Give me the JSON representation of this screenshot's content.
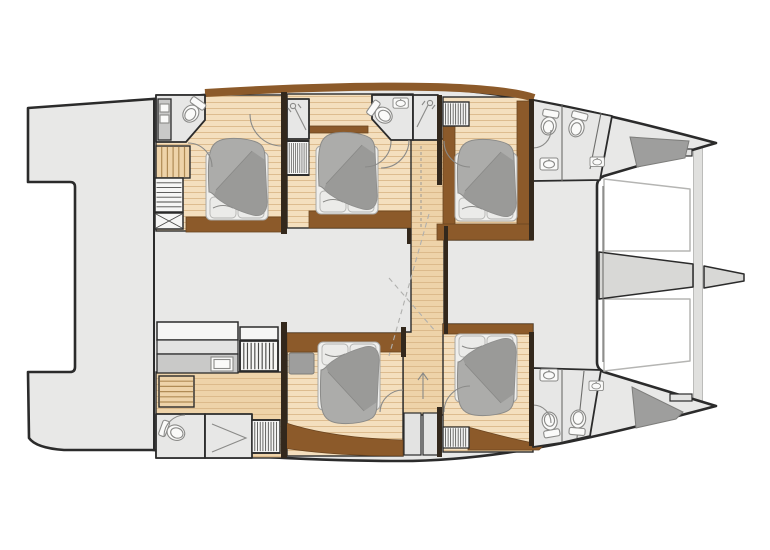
{
  "page": {
    "background": "#ffffff"
  },
  "diagram": {
    "type": "floor-plan",
    "subject": "catamaran yacht interior layout, top view, bow pointing right",
    "port_hull_rooms": [
      "aft head with vanity and toilet",
      "aft staircase",
      "aft double cabin",
      "shower cubicle",
      "midship double cabin",
      "midship head with toilet and basin",
      "midship shower",
      "companionway corridor",
      "forward double cabin",
      "forward heads with two toilets and basins"
    ],
    "starboard_hull_rooms": [
      "stern utility area with counter and sink",
      "stern staircase",
      "stern head with toilet",
      "stern shower",
      "midship double cabin with ottoman",
      "companionway corridor",
      "forward double cabin",
      "forward heads with two toilets and basins"
    ],
    "shared_features": [
      "aft platform with transoms",
      "bridgedeck salon area",
      "bow trampolines",
      "forward crossbeam",
      "bowsprit",
      "bow sunpads",
      "hanging lockers",
      "shelved wardrobe"
    ],
    "counts": {
      "double_beds": 5,
      "toilets": 7,
      "showers": 3,
      "staircases": 2,
      "wardrobes": 6,
      "sunpads": 2,
      "trampolines": 2
    }
  },
  "colors": {
    "background": "#ffffff",
    "outline": "#2b2b2b",
    "deck": "#e8e8e7",
    "wood_light": "#f4dfbe",
    "wood_line": "#d8b483",
    "wood_mid": "#eed3a9",
    "wood_tread": "#b08b55",
    "brown": "#8c5a2a",
    "wall": "#33281c",
    "bath_floor": "#e7e7e6",
    "fixture": "#fafaf9",
    "fixture_line": "#8a8a88",
    "duvet": "#acacaa",
    "duvet_shade": "#979795",
    "linen": "#efefed",
    "pillow": "#ebebe9",
    "pad": "#9e9e9d",
    "counter": "#c9c9c8",
    "panel": "#e3e3e2",
    "tramp_line": "#b5b5b3",
    "beam": "#e0e0de",
    "bowsprit": "#d8d8d6"
  }
}
